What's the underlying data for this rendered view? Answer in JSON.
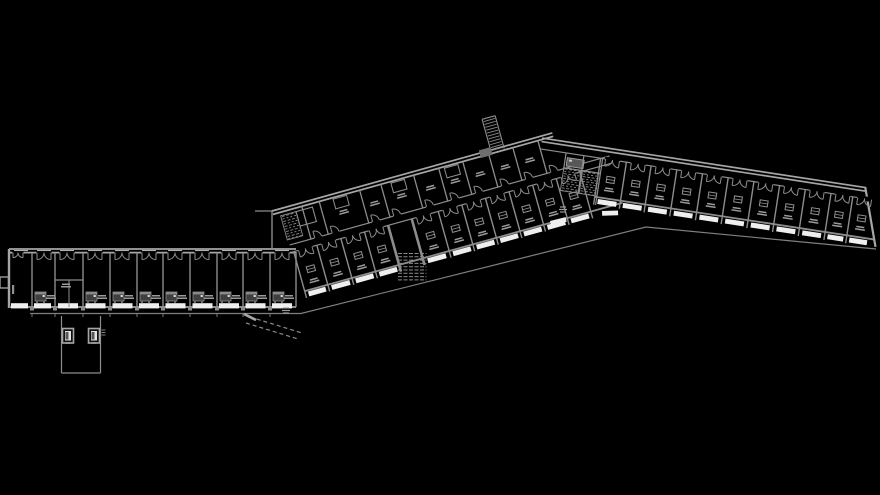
{
  "canvas": {
    "width": 880,
    "height": 495,
    "background": "#000000"
  },
  "title": "apartment-building-floor-plan",
  "palette": {
    "wall": "#a6a6a6",
    "wallDim": "#8d8d8d",
    "thin": "#7f7f7f",
    "sill": "#d0d0d0",
    "balcony": "#efefef",
    "bedFill": "#3f3f3f",
    "bedHead": "#8a8a8a",
    "bedLeg": "#6a6a6a",
    "bedSpeck": "#d8d8d8",
    "table": "#909090",
    "label": "#9b9b9b",
    "hatch": "#8a8a8a",
    "tick": "#787878",
    "core": "#585858",
    "coreSpeck": "#cfcfcf",
    "black": "#000000"
  },
  "wings": {
    "left": {
      "origin": [
        9,
        249
      ],
      "angle": 0,
      "length": 287,
      "wallY": [
        0,
        3.6
      ],
      "roomBottom": 58,
      "dividerTop": 3.6,
      "dividers": [
        23,
        46,
        74,
        101,
        128,
        154,
        181,
        208,
        234,
        261
      ],
      "balcony": {
        "y": 54.2,
        "h": 5.2,
        "w": 20
      },
      "bedCells": [
        1,
        3,
        4,
        5,
        6,
        7,
        8,
        9,
        10
      ],
      "specialCell": 2,
      "partitionY": 31,
      "railTicksY": [
        64,
        68
      ],
      "colSq": {
        "y": 57,
        "w": 4,
        "h": 4.5
      }
    },
    "diag": {
      "origin": [
        272,
        211
      ],
      "angle": -15.55,
      "length": 291,
      "wallY": [
        0,
        3.5
      ],
      "corridor": [
        37.5,
        45
      ],
      "lower": {
        "top": 45,
        "bottom": 86,
        "dividerBottom": 93,
        "dividers": [
          10,
          34,
          59,
          83.5,
          108,
          132.5,
          160,
          184.5,
          209,
          233.5,
          258,
          282.5,
          307
        ],
        "stairCellLeft": 108,
        "balcony": {
          "y": 87.2,
          "h": 5,
          "w": 19
        }
      },
      "upper": {
        "top": 3.5,
        "bottom": 37.5,
        "dividers": [
          48,
          90,
          112,
          146,
          172,
          197,
          224,
          249,
          275
        ],
        "tableCells": [
          1,
          3,
          5
        ],
        "labelCells": [
          1,
          2,
          3,
          4,
          5,
          6,
          7,
          8
        ]
      },
      "vestibule": {
        "x": 7,
        "y": 7,
        "w": 16,
        "h": 25
      },
      "sideRoom": {
        "x": 23,
        "y": 7,
        "w": 17,
        "h": 15
      },
      "ramp": {
        "x1": 227,
        "x2": 240.5,
        "yTop": -32,
        "yBot": 2,
        "block": [
          215.5,
          -3,
          12,
          8
        ]
      }
    },
    "right": {
      "origin": [
        548,
        139
      ],
      "angle": 8.7,
      "length": 334,
      "wallY": [
        0,
        3.5
      ],
      "corridorY": 11,
      "roomBottom": 50,
      "dividerBottom": 58,
      "dividers": [
        55,
        81,
        106,
        132,
        158,
        184,
        210,
        236,
        262,
        288,
        310
      ],
      "endWall": {
        "x1": 321,
        "y1": 0,
        "x2": 340,
        "y2": 57
      },
      "balcony": {
        "y": 51.8,
        "h": 5,
        "w": 19
      },
      "core": {
        "dark": [
          22,
          15.5,
          17,
          8.5
        ],
        "hatchA": [
          20,
          26,
          18,
          23
        ],
        "hatchB": [
          39,
          26,
          18,
          23
        ],
        "walls": [
          [
            20,
            11,
            20,
            27
          ],
          [
            38,
            11,
            38,
            50
          ],
          [
            57,
            11,
            57,
            58
          ],
          [
            20,
            26,
            57,
            26
          ]
        ]
      }
    }
  },
  "globals": {
    "rail": [
      [
        30,
        313.5
      ],
      [
        301,
        313.5
      ],
      [
        646,
        227
      ],
      [
        876,
        249
      ]
    ],
    "stairTreads": {
      "x1": 398,
      "x2": 426.5,
      "yStart": 253.5,
      "step": 3.3,
      "rows": 9
    },
    "lobby": {
      "left": 61.5,
      "right": 100.5,
      "top": 316,
      "bottom": 373,
      "elevators": [
        [
          62.5,
          328.5
        ],
        [
          88.5,
          328.5
        ]
      ],
      "boxW": 11,
      "boxH": 14.5,
      "hatchTicks": {
        "x": 101.5,
        "y": 330,
        "n": 3,
        "len": 4,
        "step": 2.5
      }
    },
    "westStub": [
      0,
      277,
      8.5,
      11
    ],
    "westEndWall": {
      "vertical": [
        272,
        211,
        272,
        250
      ],
      "stub": [
        255,
        211,
        272,
        211
      ]
    },
    "leftWingEndWall": [
      296,
      252,
      296,
      307
    ],
    "exteriorPath": {
      "dashA": [
        250,
        317,
        302,
        333
      ],
      "dashB": [
        246,
        323,
        298,
        339
      ],
      "stub": [
        244,
        314,
        256,
        320
      ]
    },
    "junctionBalconies": [
      {
        "x": 550,
        "y": 221,
        "rot": -14
      },
      {
        "x": 602,
        "y": 211,
        "rot": -2
      }
    ],
    "labelMarks": [
      [
        286,
        308
      ],
      [
        563,
        207
      ]
    ]
  }
}
